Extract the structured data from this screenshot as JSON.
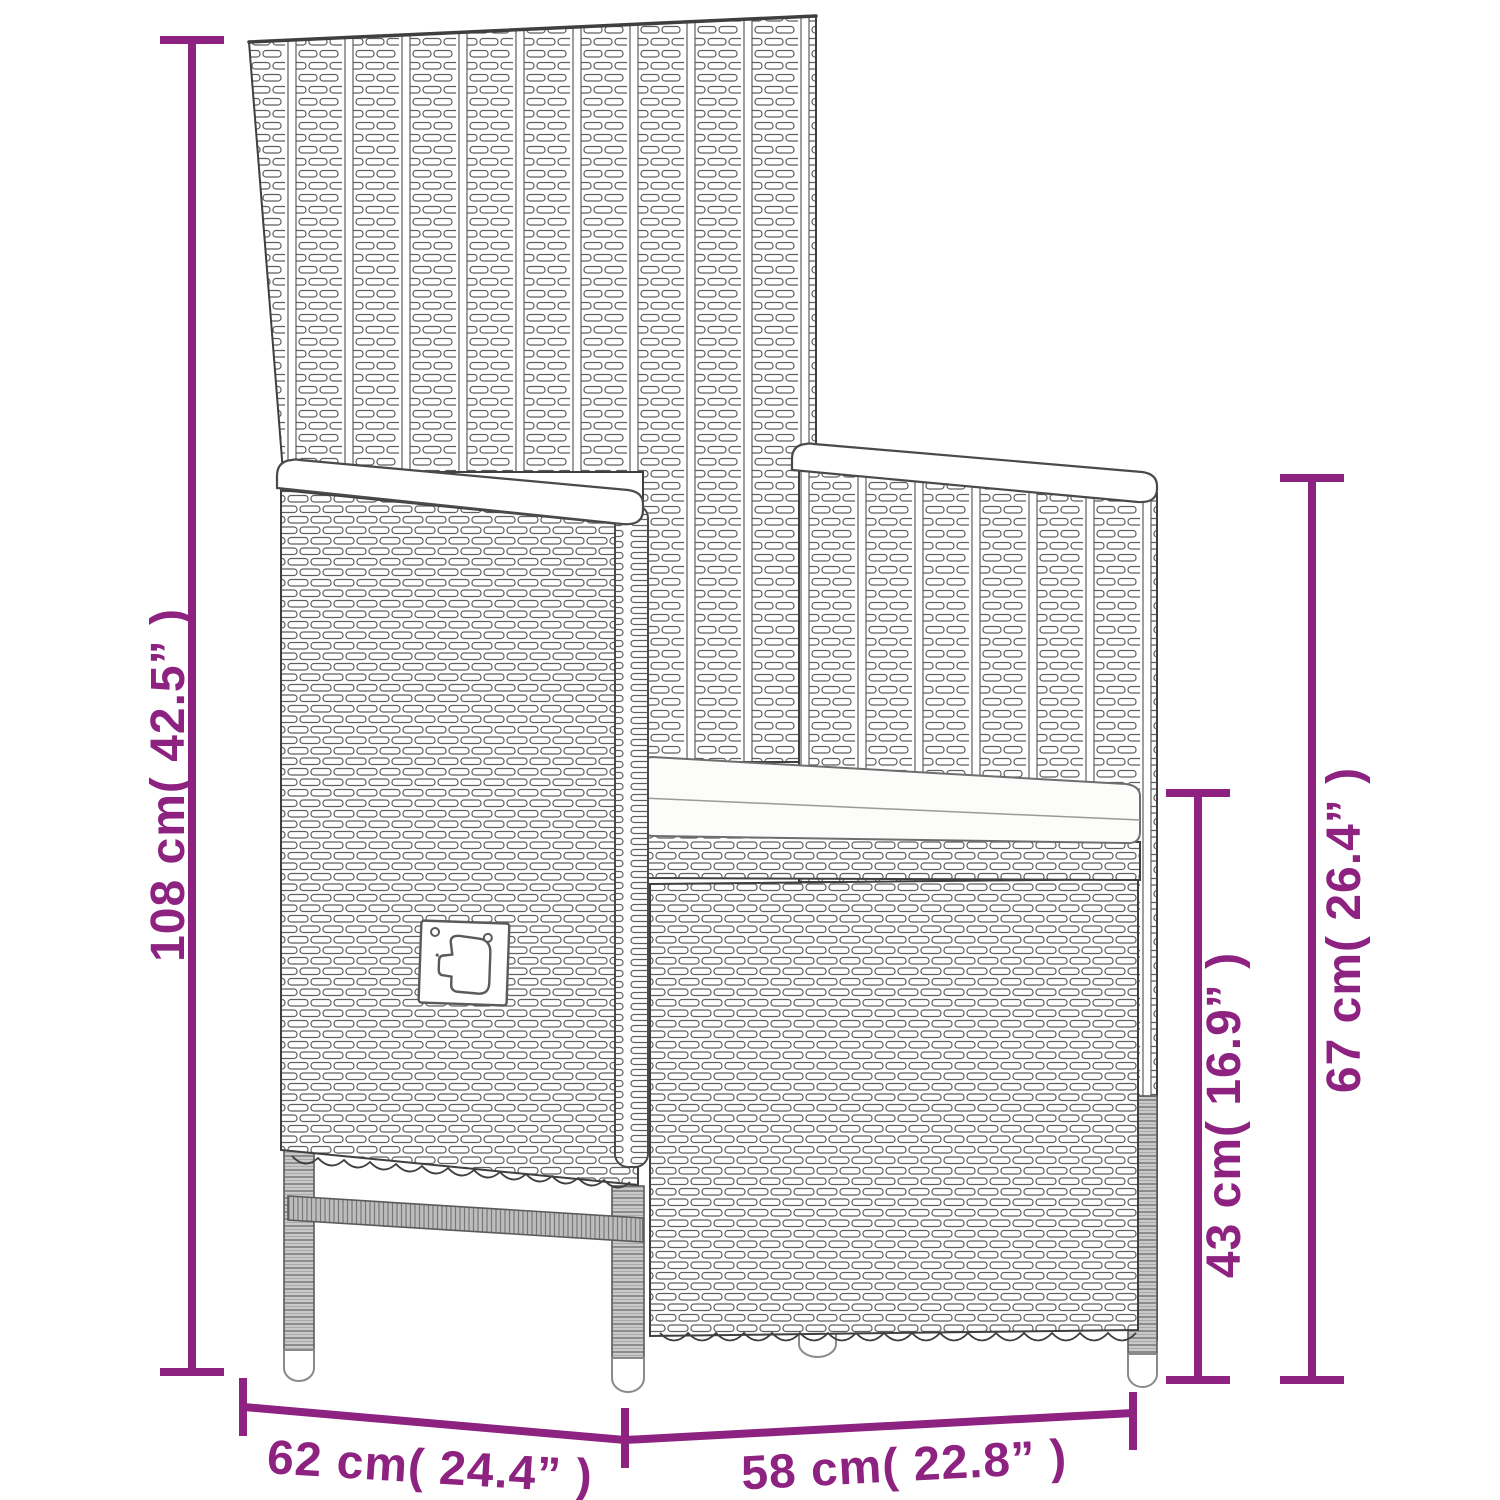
{
  "diagram": {
    "subject": "Poly rattan reclining garden chair with seat cushion — dimension drawing",
    "accent_color": "#8e2280",
    "outline_color": "#3f3f3f",
    "background": "#ffffff",
    "dimensions": {
      "overall_height": {
        "label": "108 cm( 42.5” )",
        "cm": 108,
        "inches": 42.5
      },
      "armrest_height": {
        "label": "67 cm( 26.4” )",
        "cm": 67,
        "inches": 26.4
      },
      "seat_height": {
        "label": "43 cm( 16.9” )",
        "cm": 43,
        "inches": 16.9
      },
      "seat_depth": {
        "label": "62 cm( 24.4” )",
        "cm": 62,
        "inches": 24.4
      },
      "seat_width": {
        "label": "58 cm( 22.8” )",
        "cm": 58,
        "inches": 22.8
      }
    }
  }
}
